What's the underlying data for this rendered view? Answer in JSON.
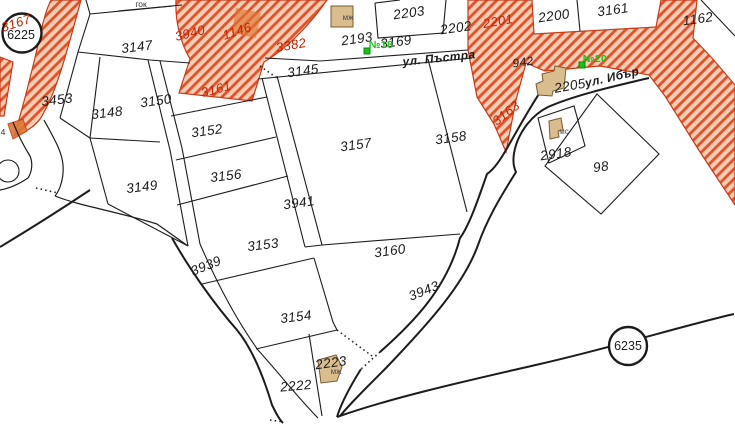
{
  "map": {
    "title": "cadastral-parcel-map",
    "colors": {
      "hatch_stripe": "#e0512b",
      "hatch_bg": "#f7cdb4",
      "hatch_border": "#c93a18",
      "building_fill": "#d9bd8e",
      "building_stroke": "#7a5c2e",
      "blob_orange": "#dd7733",
      "marker_green": "#17c317",
      "label_red": "#c42200",
      "line_black": "#1c1c1c"
    },
    "labels": [
      {
        "id": "parcel-3147",
        "text": "3147",
        "x": 137,
        "y": 47,
        "rot": -7,
        "type": "parcel"
      },
      {
        "id": "parcel-3453",
        "text": "3453",
        "x": 57,
        "y": 100,
        "rot": -7,
        "type": "parcel"
      },
      {
        "id": "parcel-3148",
        "text": "3148",
        "x": 107,
        "y": 113,
        "rot": -7,
        "type": "parcel"
      },
      {
        "id": "parcel-3150",
        "text": "3150",
        "x": 156,
        "y": 101,
        "rot": -8,
        "type": "parcel"
      },
      {
        "id": "parcel-3152",
        "text": "3152",
        "x": 207,
        "y": 131,
        "rot": -8,
        "type": "parcel"
      },
      {
        "id": "parcel-3156",
        "text": "3156",
        "x": 226,
        "y": 176,
        "rot": -7,
        "type": "parcel"
      },
      {
        "id": "parcel-3149",
        "text": "3149",
        "x": 142,
        "y": 187,
        "rot": -7,
        "type": "parcel"
      },
      {
        "id": "parcel-3153",
        "text": "3153",
        "x": 263,
        "y": 245,
        "rot": -7,
        "type": "parcel"
      },
      {
        "id": "parcel-3154",
        "text": "3154",
        "x": 296,
        "y": 317,
        "rot": -7,
        "type": "parcel"
      },
      {
        "id": "parcel-2222",
        "text": "2222",
        "x": 296,
        "y": 386,
        "rot": -5,
        "type": "parcel"
      },
      {
        "id": "parcel-2223",
        "text": "2223",
        "x": 331,
        "y": 363,
        "rot": -8,
        "type": "parcel"
      },
      {
        "id": "parcel-3157",
        "text": "3157",
        "x": 356,
        "y": 145,
        "rot": -8,
        "type": "parcel"
      },
      {
        "id": "parcel-3941",
        "text": "3941",
        "x": 299,
        "y": 203,
        "rot": -8,
        "type": "parcel"
      },
      {
        "id": "parcel-3158",
        "text": "3158",
        "x": 451,
        "y": 138,
        "rot": -8,
        "type": "parcel"
      },
      {
        "id": "parcel-3160",
        "text": "3160",
        "x": 390,
        "y": 251,
        "rot": -8,
        "type": "parcel"
      },
      {
        "id": "parcel-3145",
        "text": "3145",
        "x": 303,
        "y": 71,
        "rot": -8,
        "type": "parcel"
      },
      {
        "id": "parcel-2193",
        "text": "2193",
        "x": 357,
        "y": 39,
        "rot": -8,
        "type": "parcel"
      },
      {
        "id": "parcel-3169",
        "text": "3169",
        "x": 396,
        "y": 42,
        "rot": -8,
        "type": "parcel"
      },
      {
        "id": "parcel-2203",
        "text": "2203",
        "x": 409,
        "y": 13,
        "rot": -8,
        "type": "parcel"
      },
      {
        "id": "parcel-2202",
        "text": "2202",
        "x": 456,
        "y": 28,
        "rot": -8,
        "type": "parcel"
      },
      {
        "id": "parcel-2200",
        "text": "2200",
        "x": 554,
        "y": 16,
        "rot": -8,
        "type": "parcel"
      },
      {
        "id": "parcel-3161-ne",
        "text": "3161",
        "x": 613,
        "y": 10,
        "rot": -8,
        "type": "parcel"
      },
      {
        "id": "parcel-1162",
        "text": "1162",
        "x": 698,
        "y": 19,
        "rot": -8,
        "type": "parcel"
      },
      {
        "id": "parcel-942",
        "text": "942",
        "x": 523,
        "y": 62,
        "rot": -8,
        "type": "small"
      },
      {
        "id": "parcel-2205",
        "text": "2205",
        "x": 570,
        "y": 86,
        "rot": -10,
        "type": "parcel"
      },
      {
        "id": "parcel-2918",
        "text": "2918",
        "x": 556,
        "y": 154,
        "rot": -8,
        "type": "parcel"
      },
      {
        "id": "parcel-98",
        "text": "98",
        "x": 601,
        "y": 167,
        "rot": -8,
        "type": "parcel"
      },
      {
        "id": "road-3939",
        "text": "3939",
        "x": 206,
        "y": 266,
        "rot": -22,
        "type": "parcel"
      },
      {
        "id": "road-3943",
        "text": "3943",
        "x": 424,
        "y": 291,
        "rot": -22,
        "type": "parcel"
      },
      {
        "id": "fragment-4",
        "text": "4",
        "x": 3,
        "y": 132,
        "rot": 0,
        "type": "note"
      },
      {
        "id": "street-3940",
        "text": "3940",
        "x": 190,
        "y": 33,
        "rot": -14,
        "type": "red"
      },
      {
        "id": "street-1146",
        "text": "1146",
        "x": 237,
        "y": 31,
        "rot": -18,
        "type": "red"
      },
      {
        "id": "street-3382",
        "text": "3382",
        "x": 291,
        "y": 45,
        "rot": -10,
        "type": "red"
      },
      {
        "id": "street-3161-red",
        "text": "3161",
        "x": 216,
        "y": 89,
        "rot": -15,
        "type": "red"
      },
      {
        "id": "street-2201",
        "text": "2201",
        "x": 498,
        "y": 21,
        "rot": -10,
        "type": "red"
      },
      {
        "id": "street-3163",
        "text": "3163",
        "x": 506,
        "y": 113,
        "rot": -38,
        "type": "red"
      },
      {
        "id": "street-3167",
        "text": "3167",
        "x": 16,
        "y": 23,
        "rot": -18,
        "type": "red"
      },
      {
        "id": "street-pastra",
        "text": "ул. Пъстра",
        "x": 439,
        "y": 58,
        "rot": -6,
        "type": "street"
      },
      {
        "id": "street-ibar",
        "text": "ул. Ибър",
        "x": 612,
        "y": 77,
        "rot": -13,
        "type": "street"
      },
      {
        "id": "building-mzh-north",
        "text": "мж",
        "x": 348,
        "y": 18,
        "rot": 0,
        "type": "bld"
      },
      {
        "id": "building-mzh-south",
        "text": "мж",
        "x": 336,
        "y": 372,
        "rot": 0,
        "type": "bld"
      },
      {
        "id": "building-ms",
        "text": "мс",
        "x": 564,
        "y": 132,
        "rot": 0,
        "type": "bld"
      },
      {
        "id": "note-gok",
        "text": "гок",
        "x": 141,
        "y": 4,
        "rot": 0,
        "type": "note"
      },
      {
        "id": "marker-no18",
        "text": "№18",
        "x": 381,
        "y": 45,
        "rot": 0,
        "type": "marker"
      },
      {
        "id": "marker-no20",
        "text": "№20",
        "x": 595,
        "y": 59,
        "rot": 0,
        "type": "marker"
      },
      {
        "id": "survey-6225",
        "text": "6225",
        "x": 21,
        "y": 35,
        "rot": 0,
        "type": "circle"
      },
      {
        "id": "survey-6235",
        "text": "6235",
        "x": 628,
        "y": 346,
        "rot": 0,
        "type": "circle"
      }
    ],
    "markers": [
      {
        "id": "marker-square-no18",
        "x": 367,
        "y": 51
      },
      {
        "id": "marker-square-no20",
        "x": 582,
        "y": 65
      }
    ],
    "survey_circles": [
      {
        "id": "survey-circle-6225",
        "x": 22,
        "y": 33,
        "r": 19.5
      },
      {
        "id": "survey-circle-6235",
        "x": 628,
        "y": 346,
        "r": 19
      }
    ]
  }
}
